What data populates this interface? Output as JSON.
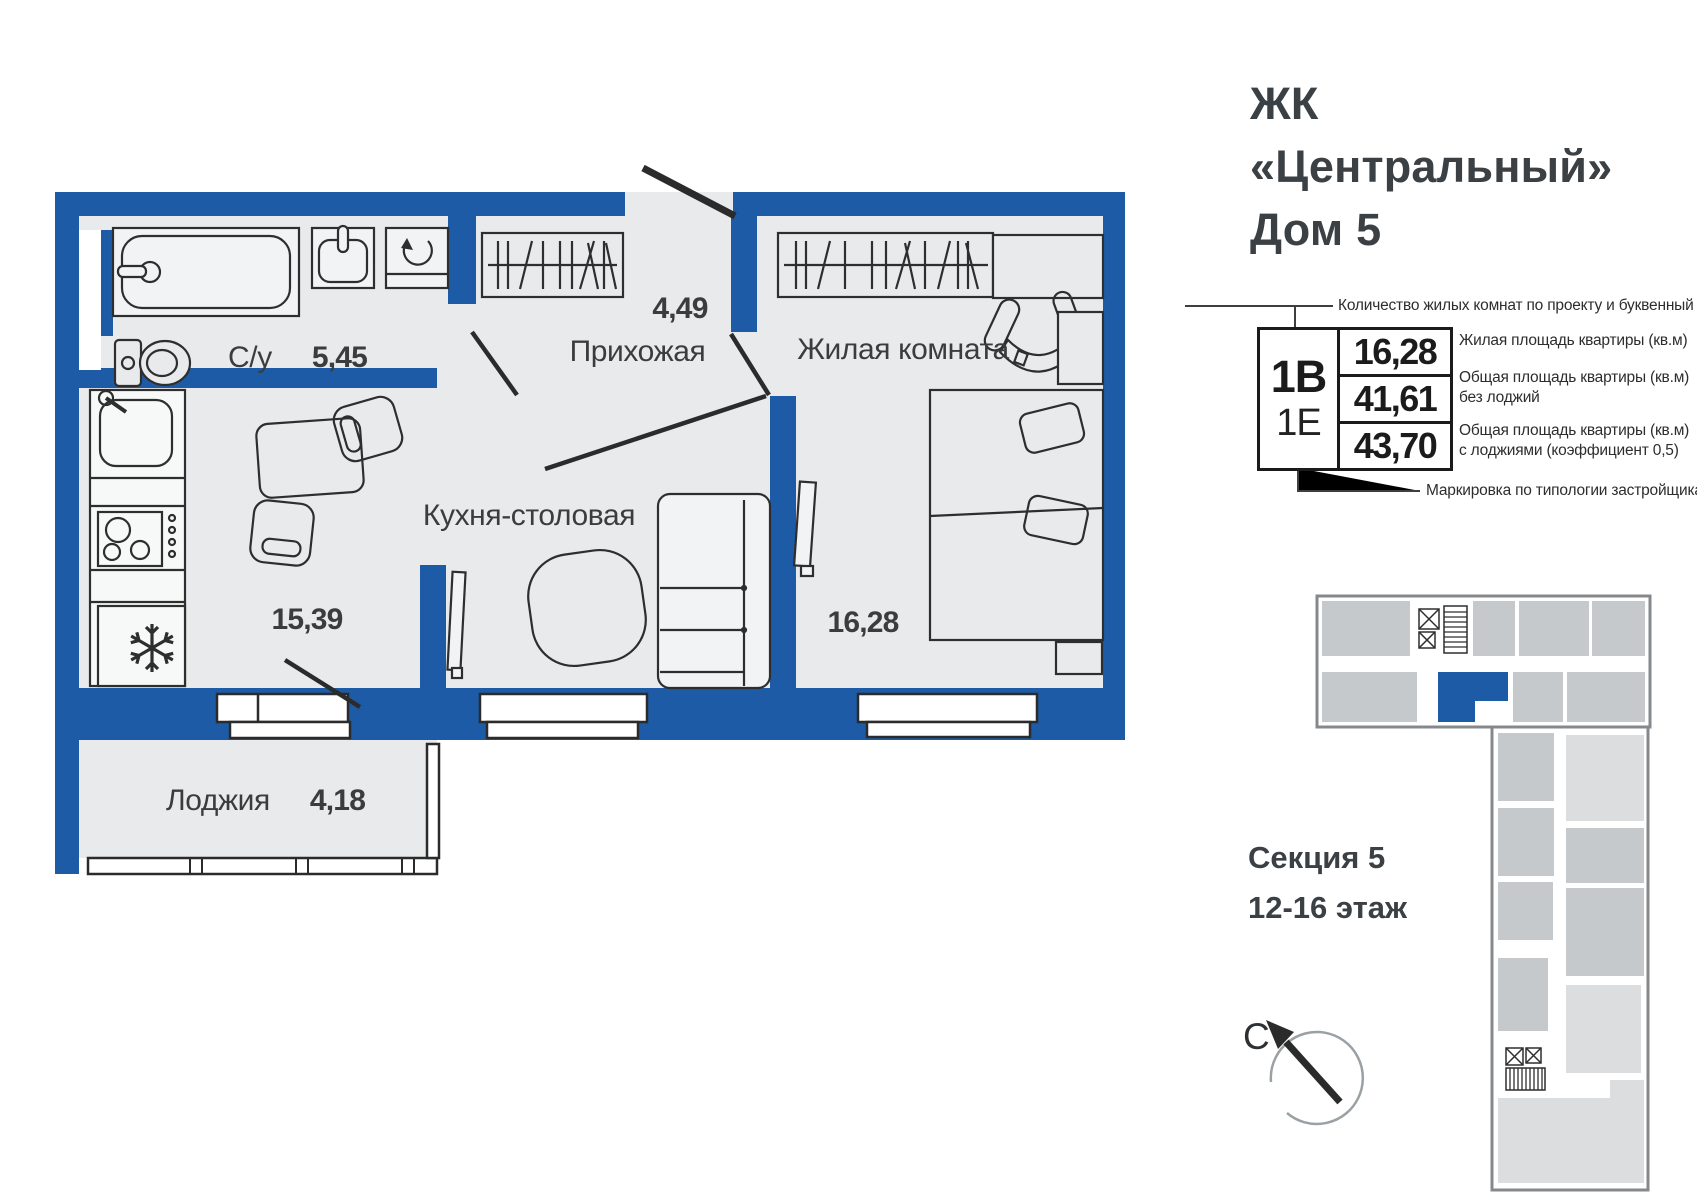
{
  "title": {
    "line1": "ЖК",
    "line2": "«Центральный»",
    "line3": "Дом 5"
  },
  "spec": {
    "type_code": "1В",
    "type_code_secondary": "1Е",
    "living_area": "16,28",
    "total_area": "41,61",
    "total_area_with_loggia": "43,70",
    "note_top": "Количество жилых комнат по проекту и буквенный код",
    "note_living": "Жилая площадь квартиры (кв.м)",
    "note_total_line1": "Общая площадь квартиры (кв.м)",
    "note_total_line2": "без лоджий",
    "note_total_loggia_line1": "Общая площадь квартиры (кв.м)",
    "note_total_loggia_line2": "с лоджиями (коэффициент 0,5)",
    "note_bottom": "Маркировка по типологии застройщика"
  },
  "rooms": {
    "bathroom": {
      "name": "С/у",
      "area": "5,45"
    },
    "hallway": {
      "name": "Прихожая",
      "area": "4,49"
    },
    "living": {
      "name": "Жилая комната",
      "area": "16,28"
    },
    "kitchen": {
      "name": "Кухня-столовая",
      "area": "15,39"
    },
    "loggia": {
      "name": "Лоджия",
      "area": "4,18"
    }
  },
  "section": {
    "line1": "Секция 5",
    "line2": "12-16 этаж"
  },
  "compass": {
    "north_label": "С"
  },
  "colors": {
    "wall": "#1d5ba6",
    "floor": "#e9eaeb",
    "furniture_stroke": "#2e2e2e",
    "footprint_unit": "#c6c9cb",
    "footprint_unit_light": "#dbdddf",
    "footprint_outline": "#85898c",
    "highlight_unit": "#1d5ba6"
  }
}
